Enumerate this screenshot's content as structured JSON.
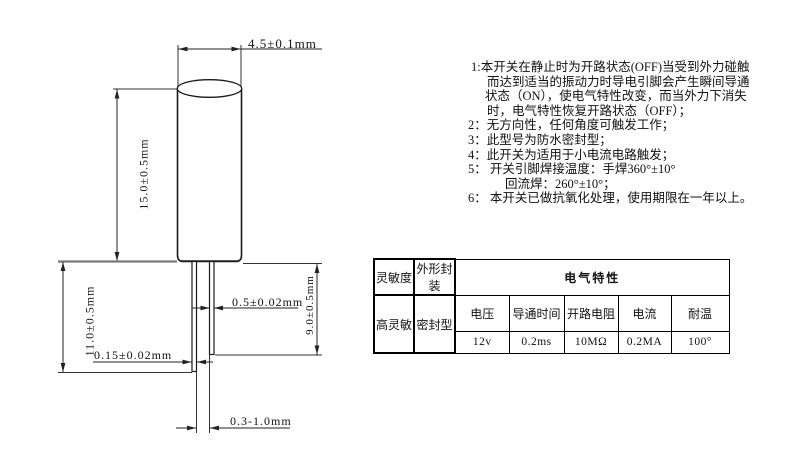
{
  "drawing": {
    "dim_body_width": "4.5±0.1mm",
    "dim_body_height": "15.0±0.5mm",
    "dim_lead_left_length": "11.0±0.5mm",
    "dim_lead_right_length": "9.0±0.5mm",
    "dim_lead_width": "0.5±0.02mm",
    "dim_lead_thickness": "0.15±0.02mm",
    "dim_lead_gap": "0.3-1.0mm"
  },
  "notes": {
    "lines": [
      "1:本开关在静止时为开路状态(OFF)当受到外力碰触",
      "而达到适当的振动力时导电引脚会产生瞬间导通",
      "状态（ON），使电气特性改变，而当外力下消失",
      "时，电气特性恢复开路状态（OFF）；",
      "2：无方向性，任何角度可触发工作；",
      "3：此型号为防水密封型；",
      "4：此开关为适用于小电流电路触发；",
      "5：  开关引脚焊接温度：手焊360°±10°",
      "回流焊：260°±10°；",
      "6：  本开关已做抗氧化处理，使用期限在一年以上。"
    ]
  },
  "spec_table": {
    "sensitivity_header": "灵敏度",
    "package_header": "外形封装",
    "electrical_title": "电气特性",
    "sensitivity_value": "高灵敏",
    "package_value": "密封型",
    "param_headers": [
      "电压",
      "导通时间",
      "开路电阻",
      "电流",
      "耐温"
    ],
    "param_values": [
      "12v",
      "0.2ms",
      "10MΩ",
      "0.2MA",
      "100°"
    ]
  }
}
